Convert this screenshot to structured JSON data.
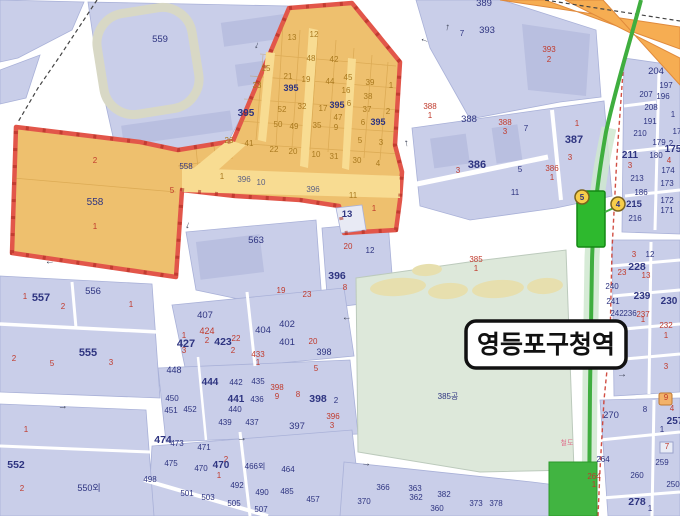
{
  "station_label": {
    "text": "영등포구청역"
  },
  "colors": {
    "zone_fill": "#eec06e",
    "zone_border": "#e2564a",
    "line_green": "#3fae3f",
    "highway_orange": "#f6ad52",
    "park_green": "#dde8da",
    "block_blue": "#c9cee9",
    "label_navy": "#2e3480",
    "label_red": "#c03a2c",
    "label_orange": "#a9791f",
    "road_label": "#5c6184",
    "railway_pink": "#e0708c",
    "exit_yellow": "#f7cd4a"
  },
  "station_exits": [
    {
      "n": "5",
      "x": 582,
      "y": 197
    },
    {
      "n": "4",
      "x": 618,
      "y": 204
    }
  ],
  "road_arrows": [
    {
      "g": "←",
      "x": 50,
      "y": 264,
      "r": -5
    },
    {
      "g": "↓",
      "x": 187,
      "y": 228,
      "r": 15
    },
    {
      "g": "→",
      "x": 63,
      "y": 409,
      "r": -6
    },
    {
      "g": "→",
      "x": 242,
      "y": 441,
      "r": -6
    },
    {
      "g": "→",
      "x": 366,
      "y": 466,
      "r": 6
    },
    {
      "g": "←",
      "x": 347,
      "y": 320,
      "r": -5
    },
    {
      "g": "→",
      "x": 622,
      "y": 377,
      "r": 0
    },
    {
      "g": "↑",
      "x": 447,
      "y": 30,
      "r": 10
    },
    {
      "g": "←",
      "x": 424,
      "y": 42,
      "r": 20
    },
    {
      "g": "↓",
      "x": 256,
      "y": 48,
      "r": 20
    },
    {
      "g": "↑",
      "x": 407,
      "y": 146,
      "r": -10
    }
  ],
  "map_labels": [
    {
      "t": "559",
      "x": 160,
      "y": 42,
      "c": "n",
      "s": 9.5
    },
    {
      "t": "13",
      "x": 292,
      "y": 40,
      "c": "o"
    },
    {
      "t": "12",
      "x": 314,
      "y": 37,
      "c": "o"
    },
    {
      "t": "48",
      "x": 311,
      "y": 61,
      "c": "o"
    },
    {
      "t": "42",
      "x": 334,
      "y": 62,
      "c": "o"
    },
    {
      "t": "15",
      "x": 266,
      "y": 71,
      "c": "o"
    },
    {
      "t": "33",
      "x": 257,
      "y": 88,
      "c": "o"
    },
    {
      "t": "21",
      "x": 288,
      "y": 79,
      "c": "o"
    },
    {
      "t": "19",
      "x": 306,
      "y": 82,
      "c": "o"
    },
    {
      "t": "395",
      "x": 291,
      "y": 91,
      "c": "n",
      "b": 1,
      "s": 9
    },
    {
      "t": "44",
      "x": 330,
      "y": 84,
      "c": "o"
    },
    {
      "t": "45",
      "x": 348,
      "y": 80,
      "c": "o"
    },
    {
      "t": "39",
      "x": 370,
      "y": 85,
      "c": "o"
    },
    {
      "t": "1",
      "x": 391,
      "y": 88,
      "c": "o"
    },
    {
      "t": "16",
      "x": 346,
      "y": 93,
      "c": "o"
    },
    {
      "t": "38",
      "x": 368,
      "y": 99,
      "c": "o"
    },
    {
      "t": "395",
      "x": 246,
      "y": 116,
      "c": "n",
      "b": 1,
      "s": 10
    },
    {
      "t": "52",
      "x": 282,
      "y": 112,
      "c": "o"
    },
    {
      "t": "32",
      "x": 302,
      "y": 109,
      "c": "o"
    },
    {
      "t": "17",
      "x": 323,
      "y": 111,
      "c": "o"
    },
    {
      "t": "395",
      "x": 337,
      "y": 108,
      "c": "n",
      "b": 1,
      "s": 9
    },
    {
      "t": "6",
      "x": 349,
      "y": 106,
      "c": "o"
    },
    {
      "t": "37",
      "x": 367,
      "y": 112,
      "c": "o"
    },
    {
      "t": "2",
      "x": 388,
      "y": 114,
      "c": "o"
    },
    {
      "t": "47",
      "x": 338,
      "y": 120,
      "c": "o"
    },
    {
      "t": "6",
      "x": 363,
      "y": 125,
      "c": "o"
    },
    {
      "t": "395",
      "x": 378,
      "y": 125,
      "c": "n",
      "b": 1,
      "s": 9
    },
    {
      "t": "50",
      "x": 278,
      "y": 127,
      "c": "o"
    },
    {
      "t": "49",
      "x": 294,
      "y": 129,
      "c": "o"
    },
    {
      "t": "35",
      "x": 317,
      "y": 128,
      "c": "o"
    },
    {
      "t": "9",
      "x": 336,
      "y": 130,
      "c": "o"
    },
    {
      "t": "26",
      "x": 229,
      "y": 143,
      "c": "o"
    },
    {
      "t": "41",
      "x": 249,
      "y": 146,
      "c": "o"
    },
    {
      "t": "22",
      "x": 274,
      "y": 152,
      "c": "o"
    },
    {
      "t": "20",
      "x": 293,
      "y": 154,
      "c": "o"
    },
    {
      "t": "10",
      "x": 316,
      "y": 157,
      "c": "o"
    },
    {
      "t": "31",
      "x": 334,
      "y": 159,
      "c": "o"
    },
    {
      "t": "5",
      "x": 360,
      "y": 143,
      "c": "o"
    },
    {
      "t": "3",
      "x": 381,
      "y": 145,
      "c": "o"
    },
    {
      "t": "30",
      "x": 357,
      "y": 163,
      "c": "o"
    },
    {
      "t": "4",
      "x": 378,
      "y": 166,
      "c": "o"
    },
    {
      "t": "2",
      "x": 95,
      "y": 163,
      "c": "r"
    },
    {
      "t": "558",
      "x": 95,
      "y": 205,
      "c": "n",
      "s": 10
    },
    {
      "t": "1",
      "x": 95,
      "y": 229,
      "c": "r"
    },
    {
      "t": "558",
      "x": 186,
      "y": 169,
      "c": "n"
    },
    {
      "t": "5",
      "x": 172,
      "y": 193,
      "c": "r"
    },
    {
      "t": "1",
      "x": 222,
      "y": 179,
      "c": "o"
    },
    {
      "t": "396",
      "x": 244,
      "y": 182,
      "c": "rd"
    },
    {
      "t": "10",
      "x": 261,
      "y": 185,
      "c": "rd"
    },
    {
      "t": "396",
      "x": 313,
      "y": 192,
      "c": "rd"
    },
    {
      "t": "11",
      "x": 353,
      "y": 198,
      "c": "o"
    },
    {
      "t": "13",
      "x": 347,
      "y": 217,
      "c": "n",
      "b": 1,
      "s": 9.5
    },
    {
      "t": "1",
      "x": 374,
      "y": 211,
      "c": "r"
    },
    {
      "t": "563",
      "x": 256,
      "y": 243,
      "c": "n",
      "s": 9.5
    },
    {
      "t": "19",
      "x": 281,
      "y": 293,
      "c": "r"
    },
    {
      "t": "23",
      "x": 307,
      "y": 297,
      "c": "r"
    },
    {
      "t": "20",
      "x": 348,
      "y": 249,
      "c": "r"
    },
    {
      "t": "12",
      "x": 370,
      "y": 253,
      "c": "n"
    },
    {
      "t": "396",
      "x": 337,
      "y": 279,
      "c": "n",
      "b": 1,
      "s": 10.5
    },
    {
      "t": "8",
      "x": 345,
      "y": 290,
      "c": "r"
    },
    {
      "t": "407",
      "x": 205,
      "y": 318,
      "c": "n",
      "s": 9.5
    },
    {
      "t": "424",
      "x": 207,
      "y": 334,
      "c": "r",
      "s": 9
    },
    {
      "t": "1",
      "x": 184,
      "y": 338,
      "c": "r"
    },
    {
      "t": "427",
      "x": 186,
      "y": 347,
      "c": "n",
      "b": 1,
      "s": 11
    },
    {
      "t": "3",
      "x": 184,
      "y": 353,
      "c": "r"
    },
    {
      "t": "2",
      "x": 207,
      "y": 343,
      "c": "r"
    },
    {
      "t": "423",
      "x": 223,
      "y": 345,
      "c": "n",
      "b": 1,
      "s": 10.5
    },
    {
      "t": "22",
      "x": 236,
      "y": 341,
      "c": "r"
    },
    {
      "t": "2",
      "x": 233,
      "y": 353,
      "c": "r"
    },
    {
      "t": "404",
      "x": 263,
      "y": 333,
      "c": "n",
      "s": 9.5
    },
    {
      "t": "402",
      "x": 287,
      "y": 327,
      "c": "n",
      "s": 9.5
    },
    {
      "t": "401",
      "x": 287,
      "y": 345,
      "c": "n",
      "s": 9.5
    },
    {
      "t": "20",
      "x": 313,
      "y": 344,
      "c": "r"
    },
    {
      "t": "433",
      "x": 258,
      "y": 357,
      "c": "r"
    },
    {
      "t": "1",
      "x": 258,
      "y": 365,
      "c": "r"
    },
    {
      "t": "398",
      "x": 324,
      "y": 355,
      "c": "n",
      "s": 9
    },
    {
      "t": "5",
      "x": 316,
      "y": 371,
      "c": "r"
    },
    {
      "t": "448",
      "x": 174,
      "y": 373,
      "c": "n",
      "s": 9
    },
    {
      "t": "444",
      "x": 210,
      "y": 385,
      "c": "n",
      "b": 1,
      "s": 10
    },
    {
      "t": "442",
      "x": 236,
      "y": 385,
      "c": "n"
    },
    {
      "t": "435",
      "x": 258,
      "y": 384,
      "c": "n"
    },
    {
      "t": "398",
      "x": 277,
      "y": 390,
      "c": "r"
    },
    {
      "t": "9",
      "x": 277,
      "y": 399,
      "c": "r"
    },
    {
      "t": "8",
      "x": 298,
      "y": 397,
      "c": "r"
    },
    {
      "t": "398",
      "x": 318,
      "y": 402,
      "c": "n",
      "b": 1,
      "s": 10.5
    },
    {
      "t": "2",
      "x": 336,
      "y": 403,
      "c": "n"
    },
    {
      "t": "450",
      "x": 172,
      "y": 401,
      "c": "n"
    },
    {
      "t": "451",
      "x": 171,
      "y": 413,
      "c": "n"
    },
    {
      "t": "452",
      "x": 190,
      "y": 412,
      "c": "n"
    },
    {
      "t": "441",
      "x": 236,
      "y": 402,
      "c": "n",
      "b": 1,
      "s": 10
    },
    {
      "t": "440",
      "x": 235,
      "y": 412,
      "c": "n"
    },
    {
      "t": "436",
      "x": 257,
      "y": 402,
      "c": "n"
    },
    {
      "t": "439",
      "x": 225,
      "y": 425,
      "c": "n"
    },
    {
      "t": "437",
      "x": 252,
      "y": 425,
      "c": "n"
    },
    {
      "t": "397",
      "x": 297,
      "y": 429,
      "c": "n",
      "s": 9.5
    },
    {
      "t": "396",
      "x": 333,
      "y": 419,
      "c": "r"
    },
    {
      "t": "3",
      "x": 332,
      "y": 428,
      "c": "r"
    },
    {
      "t": "474",
      "x": 163,
      "y": 443,
      "c": "n",
      "b": 1,
      "s": 10.5
    },
    {
      "t": "473",
      "x": 177,
      "y": 446,
      "c": "n"
    },
    {
      "t": "471",
      "x": 204,
      "y": 450,
      "c": "n"
    },
    {
      "t": "475",
      "x": 171,
      "y": 466,
      "c": "n"
    },
    {
      "t": "470",
      "x": 201,
      "y": 471,
      "c": "n"
    },
    {
      "t": "2",
      "x": 226,
      "y": 462,
      "c": "r"
    },
    {
      "t": "470",
      "x": 221,
      "y": 468,
      "c": "n",
      "b": 1,
      "s": 10
    },
    {
      "t": "1",
      "x": 219,
      "y": 478,
      "c": "r"
    },
    {
      "t": "466외",
      "x": 255,
      "y": 469,
      "c": "n"
    },
    {
      "t": "464",
      "x": 288,
      "y": 472,
      "c": "n"
    },
    {
      "t": "498",
      "x": 150,
      "y": 482,
      "c": "n"
    },
    {
      "t": "501",
      "x": 187,
      "y": 496,
      "c": "n"
    },
    {
      "t": "503",
      "x": 208,
      "y": 500,
      "c": "n"
    },
    {
      "t": "505",
      "x": 234,
      "y": 506,
      "c": "n"
    },
    {
      "t": "507",
      "x": 261,
      "y": 512,
      "c": "n"
    },
    {
      "t": "492",
      "x": 237,
      "y": 488,
      "c": "n"
    },
    {
      "t": "490",
      "x": 262,
      "y": 495,
      "c": "n"
    },
    {
      "t": "485",
      "x": 287,
      "y": 494,
      "c": "n"
    },
    {
      "t": "457",
      "x": 313,
      "y": 502,
      "c": "n"
    },
    {
      "t": "1",
      "x": 25,
      "y": 299,
      "c": "r"
    },
    {
      "t": "557",
      "x": 41,
      "y": 301,
      "c": "n",
      "b": 1,
      "s": 11
    },
    {
      "t": "2",
      "x": 63,
      "y": 309,
      "c": "r"
    },
    {
      "t": "556",
      "x": 93,
      "y": 294,
      "c": "n",
      "s": 9.5
    },
    {
      "t": "1",
      "x": 131,
      "y": 307,
      "c": "r"
    },
    {
      "t": "2",
      "x": 14,
      "y": 361,
      "c": "r"
    },
    {
      "t": "5",
      "x": 52,
      "y": 366,
      "c": "r"
    },
    {
      "t": "555",
      "x": 88,
      "y": 356,
      "c": "n",
      "b": 1,
      "s": 11
    },
    {
      "t": "3",
      "x": 111,
      "y": 365,
      "c": "r"
    },
    {
      "t": "1",
      "x": 26,
      "y": 432,
      "c": "r"
    },
    {
      "t": "552",
      "x": 16,
      "y": 468,
      "c": "n",
      "b": 1,
      "s": 10.5
    },
    {
      "t": "2",
      "x": 22,
      "y": 491,
      "c": "r"
    },
    {
      "t": "550외",
      "x": 89,
      "y": 491,
      "c": "n",
      "s": 9
    },
    {
      "t": "366",
      "x": 383,
      "y": 490,
      "c": "n"
    },
    {
      "t": "363",
      "x": 415,
      "y": 491,
      "c": "n"
    },
    {
      "t": "362",
      "x": 416,
      "y": 500,
      "c": "n"
    },
    {
      "t": "382",
      "x": 444,
      "y": 497,
      "c": "n"
    },
    {
      "t": "370",
      "x": 364,
      "y": 504,
      "c": "n"
    },
    {
      "t": "360",
      "x": 437,
      "y": 511,
      "c": "n"
    },
    {
      "t": "373",
      "x": 476,
      "y": 506,
      "c": "n"
    },
    {
      "t": "378",
      "x": 496,
      "y": 506,
      "c": "n"
    },
    {
      "t": "389",
      "x": 484,
      "y": 6,
      "c": "n",
      "s": 9.5
    },
    {
      "t": "393",
      "x": 487,
      "y": 33,
      "c": "n",
      "s": 9.5
    },
    {
      "t": "7",
      "x": 462,
      "y": 36,
      "c": "n"
    },
    {
      "t": "393",
      "x": 549,
      "y": 52,
      "c": "r"
    },
    {
      "t": "2",
      "x": 549,
      "y": 62,
      "c": "r"
    },
    {
      "t": "388",
      "x": 430,
      "y": 109,
      "c": "r"
    },
    {
      "t": "1",
      "x": 430,
      "y": 118,
      "c": "r"
    },
    {
      "t": "388",
      "x": 469,
      "y": 122,
      "c": "n",
      "s": 9.5
    },
    {
      "t": "388",
      "x": 505,
      "y": 125,
      "c": "r"
    },
    {
      "t": "3",
      "x": 505,
      "y": 134,
      "c": "r"
    },
    {
      "t": "7",
      "x": 526,
      "y": 131,
      "c": "n"
    },
    {
      "t": "1",
      "x": 577,
      "y": 126,
      "c": "r"
    },
    {
      "t": "387",
      "x": 574,
      "y": 143,
      "c": "n",
      "b": 1,
      "s": 11
    },
    {
      "t": "3",
      "x": 570,
      "y": 160,
      "c": "r"
    },
    {
      "t": "386",
      "x": 477,
      "y": 168,
      "c": "n",
      "b": 1,
      "s": 11
    },
    {
      "t": "3",
      "x": 458,
      "y": 173,
      "c": "r"
    },
    {
      "t": "5",
      "x": 520,
      "y": 172,
      "c": "n"
    },
    {
      "t": "386",
      "x": 552,
      "y": 171,
      "c": "r"
    },
    {
      "t": "1",
      "x": 552,
      "y": 180,
      "c": "r"
    },
    {
      "t": "11",
      "x": 515,
      "y": 195,
      "c": "n"
    },
    {
      "t": "385",
      "x": 476,
      "y": 262,
      "c": "r"
    },
    {
      "t": "1",
      "x": 476,
      "y": 271,
      "c": "r"
    },
    {
      "t": "385공",
      "x": 448,
      "y": 399,
      "c": "n"
    },
    {
      "t": "204",
      "x": 656,
      "y": 74,
      "c": "n",
      "s": 9.5
    },
    {
      "t": "197",
      "x": 666,
      "y": 88,
      "c": "n"
    },
    {
      "t": "207",
      "x": 646,
      "y": 97,
      "c": "n"
    },
    {
      "t": "196",
      "x": 663,
      "y": 99,
      "c": "n"
    },
    {
      "t": "208",
      "x": 651,
      "y": 110,
      "c": "n"
    },
    {
      "t": "191",
      "x": 650,
      "y": 124,
      "c": "n"
    },
    {
      "t": "1",
      "x": 673,
      "y": 117,
      "c": "n"
    },
    {
      "t": "210",
      "x": 640,
      "y": 136,
      "c": "n"
    },
    {
      "t": "17",
      "x": 677,
      "y": 134,
      "c": "n"
    },
    {
      "t": "179",
      "x": 659,
      "y": 145,
      "c": "n"
    },
    {
      "t": "2",
      "x": 671,
      "y": 146,
      "c": "n"
    },
    {
      "t": "211",
      "x": 630,
      "y": 158,
      "c": "n",
      "b": 1,
      "s": 10
    },
    {
      "t": "3",
      "x": 630,
      "y": 168,
      "c": "r"
    },
    {
      "t": "180",
      "x": 656,
      "y": 158,
      "c": "n"
    },
    {
      "t": "175",
      "x": 673,
      "y": 152,
      "c": "n",
      "b": 1,
      "s": 10
    },
    {
      "t": "4",
      "x": 669,
      "y": 163,
      "c": "r"
    },
    {
      "t": "174",
      "x": 668,
      "y": 173,
      "c": "n"
    },
    {
      "t": "213",
      "x": 637,
      "y": 181,
      "c": "n"
    },
    {
      "t": "173",
      "x": 667,
      "y": 186,
      "c": "n"
    },
    {
      "t": "186",
      "x": 641,
      "y": 195,
      "c": "n"
    },
    {
      "t": "172",
      "x": 667,
      "y": 203,
      "c": "n"
    },
    {
      "t": "215",
      "x": 634,
      "y": 207,
      "c": "n",
      "b": 1,
      "s": 9.5
    },
    {
      "t": "171",
      "x": 667,
      "y": 213,
      "c": "n"
    },
    {
      "t": "216",
      "x": 635,
      "y": 221,
      "c": "n"
    },
    {
      "t": "3",
      "x": 634,
      "y": 257,
      "c": "r"
    },
    {
      "t": "12",
      "x": 650,
      "y": 257,
      "c": "n"
    },
    {
      "t": "23",
      "x": 622,
      "y": 275,
      "c": "r"
    },
    {
      "t": "228",
      "x": 637,
      "y": 270,
      "c": "n",
      "b": 1,
      "s": 10.5
    },
    {
      "t": "13",
      "x": 646,
      "y": 278,
      "c": "r"
    },
    {
      "t": "240",
      "x": 612,
      "y": 289,
      "c": "n"
    },
    {
      "t": "239",
      "x": 642,
      "y": 299,
      "c": "n",
      "b": 1,
      "s": 10
    },
    {
      "t": "230",
      "x": 669,
      "y": 304,
      "c": "n",
      "b": 1,
      "s": 10
    },
    {
      "t": "241",
      "x": 613,
      "y": 304,
      "c": "n"
    },
    {
      "t": "242",
      "x": 617,
      "y": 316,
      "c": "n"
    },
    {
      "t": "236",
      "x": 630,
      "y": 316,
      "c": "n"
    },
    {
      "t": "237",
      "x": 643,
      "y": 317,
      "c": "r"
    },
    {
      "t": "1",
      "x": 643,
      "y": 322,
      "c": "r"
    },
    {
      "t": "232",
      "x": 666,
      "y": 328,
      "c": "r"
    },
    {
      "t": "1",
      "x": 666,
      "y": 338,
      "c": "r"
    },
    {
      "t": "3",
      "x": 666,
      "y": 369,
      "c": "r"
    },
    {
      "t": "9",
      "x": 666,
      "y": 400,
      "c": "r"
    },
    {
      "t": "8",
      "x": 645,
      "y": 412,
      "c": "n"
    },
    {
      "t": "4",
      "x": 672,
      "y": 411,
      "c": "r"
    },
    {
      "t": "270",
      "x": 611,
      "y": 418,
      "c": "n",
      "s": 9.5
    },
    {
      "t": "257",
      "x": 675,
      "y": 424,
      "c": "n",
      "b": 1,
      "s": 10
    },
    {
      "t": "1",
      "x": 662,
      "y": 432,
      "c": "n"
    },
    {
      "t": "7",
      "x": 667,
      "y": 449,
      "c": "r"
    },
    {
      "t": "264",
      "x": 603,
      "y": 462,
      "c": "n"
    },
    {
      "t": "259",
      "x": 662,
      "y": 465,
      "c": "n"
    },
    {
      "t": "260",
      "x": 637,
      "y": 478,
      "c": "n"
    },
    {
      "t": "264",
      "x": 594,
      "y": 479,
      "c": "r"
    },
    {
      "t": "1",
      "x": 594,
      "y": 487,
      "c": "r"
    },
    {
      "t": "250",
      "x": 673,
      "y": 487,
      "c": "n"
    },
    {
      "t": "278",
      "x": 637,
      "y": 505,
      "c": "n",
      "b": 1,
      "s": 10.5
    },
    {
      "t": "1",
      "x": 650,
      "y": 511,
      "c": "n"
    },
    {
      "t": "철도",
      "x": 567,
      "y": 445,
      "c": "p",
      "s": 7
    }
  ]
}
